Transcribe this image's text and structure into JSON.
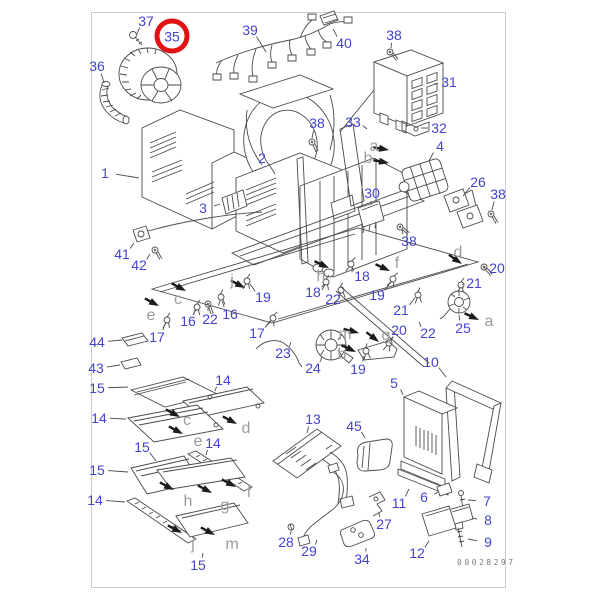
{
  "figure": {
    "code": "00028297"
  },
  "colors": {
    "label_blue": "#4343cd",
    "letter_gray": "#9b9b9b",
    "highlight_red": "#e11212",
    "line_dark": "#4a4a4a",
    "frame_gray": "#c9c9c9"
  },
  "highlight": {
    "part": "35"
  },
  "part_labels": [
    {
      "t": "37",
      "x": 146,
      "y": 21,
      "lx": 137,
      "ly": 34
    },
    {
      "t": "35",
      "x": 172,
      "y": 36,
      "circled": true
    },
    {
      "t": "36",
      "x": 97,
      "y": 66,
      "lx": 104,
      "ly": 83
    },
    {
      "t": "39",
      "x": 250,
      "y": 30,
      "lx": 266,
      "ly": 52
    },
    {
      "t": "40",
      "x": 344,
      "y": 43,
      "lx": 333,
      "ly": 29
    },
    {
      "t": "38",
      "x": 394,
      "y": 35,
      "lx": 391,
      "ly": 48
    },
    {
      "t": "31",
      "x": 449,
      "y": 82,
      "lx": 434,
      "ly": 84
    },
    {
      "t": "33",
      "x": 353,
      "y": 122,
      "lx": 367,
      "ly": 129
    },
    {
      "t": "32",
      "x": 439,
      "y": 128,
      "lx": 421,
      "ly": 128
    },
    {
      "t": "38",
      "x": 317,
      "y": 123,
      "lx": 312,
      "ly": 138
    },
    {
      "t": "2",
      "x": 262,
      "y": 158,
      "lx": 275,
      "ly": 174
    },
    {
      "t": "4",
      "x": 440,
      "y": 146,
      "lx": 429,
      "ly": 161
    },
    {
      "t": "1",
      "x": 105,
      "y": 173,
      "lx": 139,
      "ly": 178
    },
    {
      "t": "26",
      "x": 478,
      "y": 182,
      "lx": 463,
      "ly": 196
    },
    {
      "t": "38",
      "x": 498,
      "y": 194,
      "lx": 492,
      "ly": 210
    },
    {
      "t": "30",
      "x": 372,
      "y": 193,
      "lx": 371,
      "ly": 205
    },
    {
      "t": "3",
      "x": 203,
      "y": 208,
      "lx": 220,
      "ly": 204
    },
    {
      "t": "38",
      "x": 409,
      "y": 241,
      "lx": 402,
      "ly": 230
    },
    {
      "t": "41",
      "x": 122,
      "y": 254,
      "lx": 134,
      "ly": 243
    },
    {
      "t": "42",
      "x": 139,
      "y": 265,
      "lx": 150,
      "ly": 254
    },
    {
      "t": "18",
      "x": 313,
      "y": 292,
      "lx": 324,
      "ly": 284
    },
    {
      "t": "18",
      "x": 362,
      "y": 276,
      "lx": 352,
      "ly": 267
    },
    {
      "t": "22",
      "x": 333,
      "y": 299,
      "lx": 340,
      "ly": 292
    },
    {
      "t": "19",
      "x": 263,
      "y": 297,
      "lx": 250,
      "ly": 284
    },
    {
      "t": "19",
      "x": 377,
      "y": 295,
      "lx": 391,
      "ly": 282
    },
    {
      "t": "16",
      "x": 188,
      "y": 321,
      "lx": 195,
      "ly": 310
    },
    {
      "t": "22",
      "x": 210,
      "y": 319,
      "lx": 208,
      "ly": 308
    },
    {
      "t": "16",
      "x": 230,
      "y": 314,
      "lx": 222,
      "ly": 301
    },
    {
      "t": "17",
      "x": 157,
      "y": 337,
      "lx": 165,
      "ly": 324
    },
    {
      "t": "17",
      "x": 257,
      "y": 333,
      "lx": 270,
      "ly": 321
    },
    {
      "t": "23",
      "x": 283,
      "y": 353,
      "lx": 291,
      "ly": 342
    },
    {
      "t": "24",
      "x": 313,
      "y": 368,
      "lx": 322,
      "ly": 357
    },
    {
      "t": "44",
      "x": 97,
      "y": 342,
      "lx": 122,
      "ly": 340
    },
    {
      "t": "43",
      "x": 96,
      "y": 368,
      "lx": 120,
      "ly": 365
    },
    {
      "t": "20",
      "x": 497,
      "y": 268,
      "lx": 484,
      "ly": 268
    },
    {
      "t": "21",
      "x": 474,
      "y": 283,
      "lx": 462,
      "ly": 285
    },
    {
      "t": "21",
      "x": 401,
      "y": 310,
      "lx": 415,
      "ly": 298
    },
    {
      "t": "20",
      "x": 399,
      "y": 330,
      "lx": 391,
      "ly": 341
    },
    {
      "t": "22",
      "x": 428,
      "y": 333,
      "lx": 419,
      "ly": 322
    },
    {
      "t": "25",
      "x": 463,
      "y": 328,
      "lx": 459,
      "ly": 315
    },
    {
      "t": "19",
      "x": 358,
      "y": 369,
      "lx": 364,
      "ly": 356
    },
    {
      "t": "10",
      "x": 431,
      "y": 362,
      "lx": 446,
      "ly": 377
    },
    {
      "t": "5",
      "x": 394,
      "y": 383,
      "lx": 403,
      "ly": 395
    },
    {
      "t": "45",
      "x": 354,
      "y": 426,
      "lx": 365,
      "ly": 438
    },
    {
      "t": "13",
      "x": 313,
      "y": 419,
      "lx": 307,
      "ly": 433
    },
    {
      "t": "11",
      "x": 399,
      "y": 503,
      "lx": 409,
      "ly": 489
    },
    {
      "t": "6",
      "x": 424,
      "y": 497,
      "lx": 438,
      "ly": 492
    },
    {
      "t": "7",
      "x": 487,
      "y": 501,
      "lx": 468,
      "ly": 500
    },
    {
      "t": "8",
      "x": 488,
      "y": 520,
      "lx": 472,
      "ly": 518
    },
    {
      "t": "9",
      "x": 488,
      "y": 542,
      "lx": 468,
      "ly": 539
    },
    {
      "t": "27",
      "x": 384,
      "y": 524,
      "lx": 379,
      "ly": 513
    },
    {
      "t": "34",
      "x": 362,
      "y": 559,
      "lx": 366,
      "ly": 548
    },
    {
      "t": "12",
      "x": 417,
      "y": 553,
      "lx": 429,
      "ly": 541
    },
    {
      "t": "28",
      "x": 286,
      "y": 542,
      "lx": 291,
      "ly": 531
    },
    {
      "t": "29",
      "x": 309,
      "y": 551,
      "lx": 317,
      "ly": 540
    },
    {
      "t": "15",
      "x": 97,
      "y": 388,
      "lx": 128,
      "ly": 387
    },
    {
      "t": "14",
      "x": 99,
      "y": 418,
      "lx": 126,
      "ly": 419
    },
    {
      "t": "14",
      "x": 223,
      "y": 380,
      "lx": 215,
      "ly": 391
    },
    {
      "t": "14",
      "x": 213,
      "y": 443,
      "lx": 206,
      "ly": 455
    },
    {
      "t": "14",
      "x": 95,
      "y": 500,
      "lx": 125,
      "ly": 502
    },
    {
      "t": "15",
      "x": 142,
      "y": 447,
      "lx": 156,
      "ly": 461
    },
    {
      "t": "15",
      "x": 97,
      "y": 470,
      "lx": 128,
      "ly": 472
    },
    {
      "t": "15",
      "x": 198,
      "y": 565,
      "lx": 203,
      "ly": 553
    }
  ],
  "ref_letters": [
    {
      "t": "a",
      "x": 374,
      "y": 147
    },
    {
      "t": "b",
      "x": 368,
      "y": 159
    },
    {
      "t": "c",
      "x": 178,
      "y": 300
    },
    {
      "t": "e",
      "x": 151,
      "y": 316
    },
    {
      "t": "j",
      "x": 232,
      "y": 281
    },
    {
      "t": "h",
      "x": 321,
      "y": 277
    },
    {
      "t": "f",
      "x": 397,
      "y": 264
    },
    {
      "t": "d",
      "x": 458,
      "y": 253
    },
    {
      "t": "m",
      "x": 345,
      "y": 335
    },
    {
      "t": "g",
      "x": 386,
      "y": 336
    },
    {
      "t": "b",
      "x": 342,
      "y": 355
    },
    {
      "t": "a",
      "x": 489,
      "y": 322
    },
    {
      "t": "c",
      "x": 187,
      "y": 421
    },
    {
      "t": "d",
      "x": 246,
      "y": 429
    },
    {
      "t": "e",
      "x": 198,
      "y": 442
    },
    {
      "t": "f",
      "x": 249,
      "y": 493
    },
    {
      "t": "h",
      "x": 188,
      "y": 502
    },
    {
      "t": "g",
      "x": 225,
      "y": 506
    },
    {
      "t": "j",
      "x": 193,
      "y": 545
    },
    {
      "t": "m",
      "x": 232,
      "y": 545
    }
  ],
  "arrows": [
    {
      "x": 389,
      "y": 150,
      "a": 10
    },
    {
      "x": 389,
      "y": 163,
      "a": 10
    },
    {
      "x": 186,
      "y": 291,
      "a": 28
    },
    {
      "x": 159,
      "y": 306,
      "a": 28
    },
    {
      "x": 245,
      "y": 288,
      "a": 28
    },
    {
      "x": 329,
      "y": 268,
      "a": 25
    },
    {
      "x": 390,
      "y": 271,
      "a": 25
    },
    {
      "x": 462,
      "y": 264,
      "a": 35
    },
    {
      "x": 359,
      "y": 333,
      "a": 15
    },
    {
      "x": 379,
      "y": 342,
      "a": 38
    },
    {
      "x": 356,
      "y": 352,
      "a": 25
    },
    {
      "x": 479,
      "y": 320,
      "a": 25
    },
    {
      "x": 180,
      "y": 417,
      "a": 28
    },
    {
      "x": 237,
      "y": 424,
      "a": 28
    },
    {
      "x": 183,
      "y": 434,
      "a": 28
    },
    {
      "x": 236,
      "y": 487,
      "a": 28
    },
    {
      "x": 212,
      "y": 493,
      "a": 28
    },
    {
      "x": 174,
      "y": 490,
      "a": 28
    },
    {
      "x": 182,
      "y": 533,
      "a": 28
    },
    {
      "x": 215,
      "y": 535,
      "a": 28
    }
  ]
}
